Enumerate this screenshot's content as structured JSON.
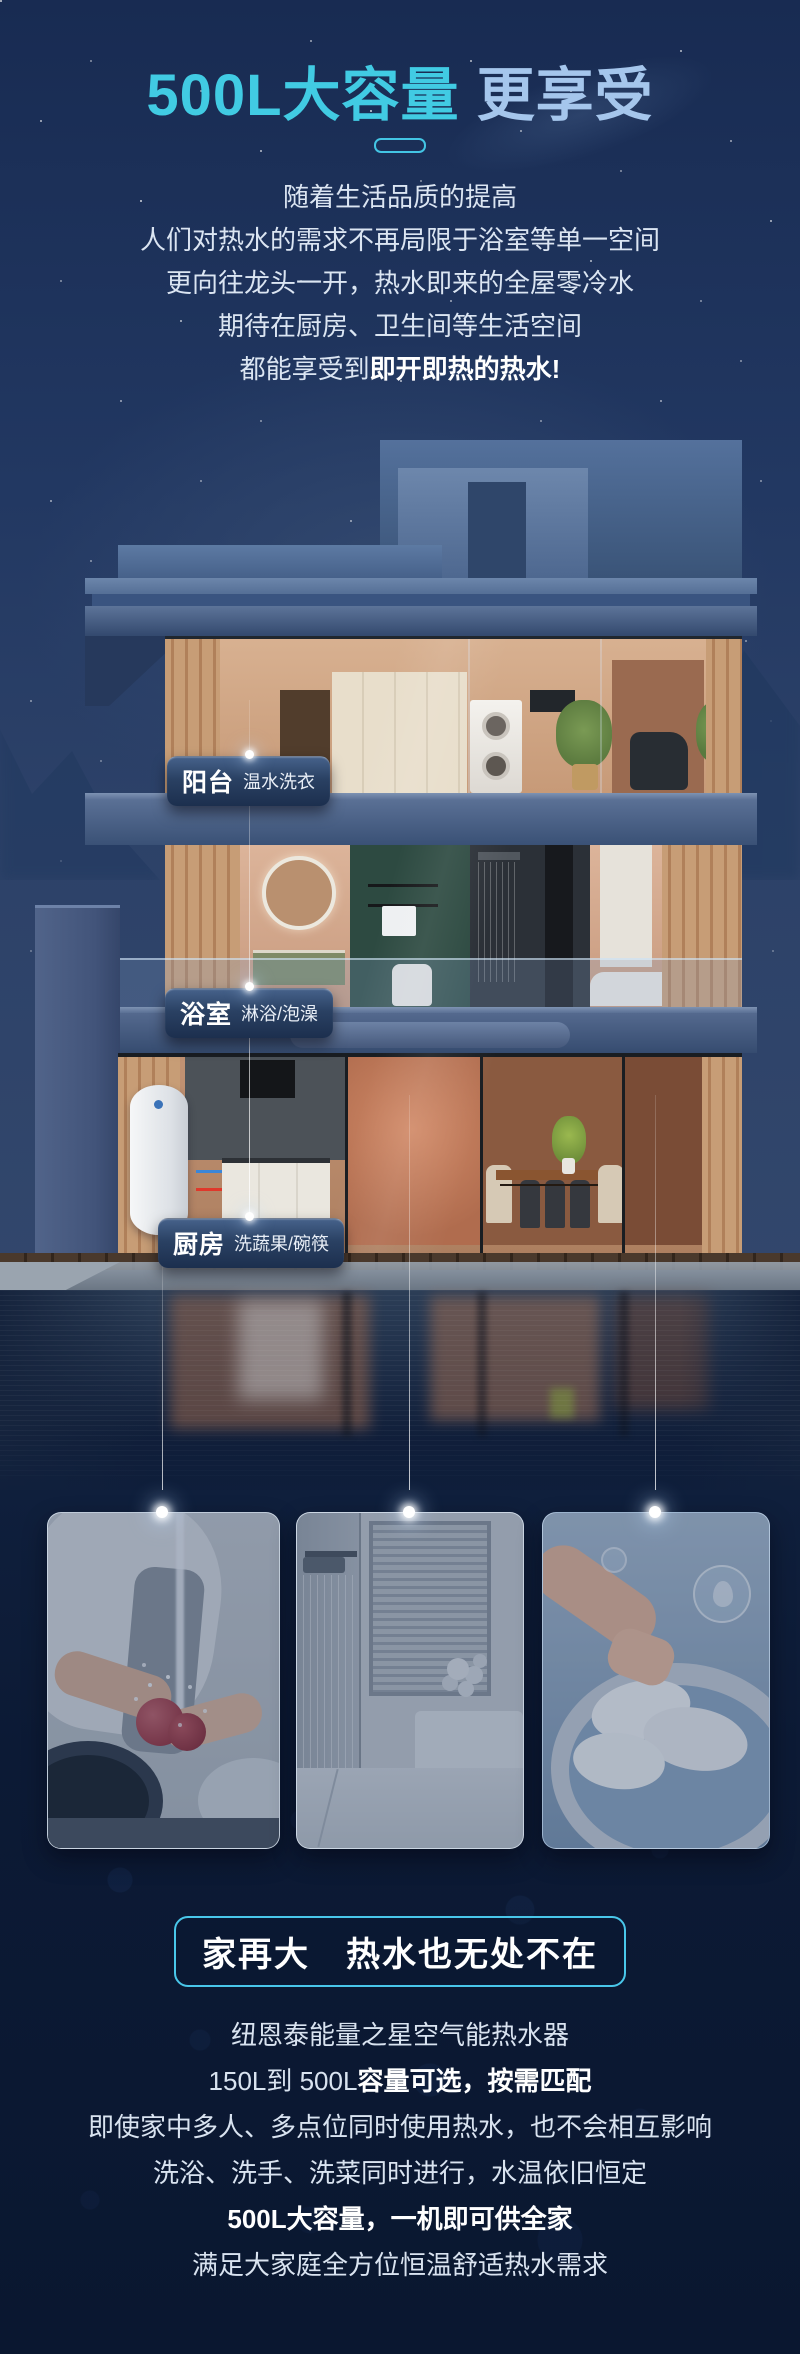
{
  "page": {
    "title_highlight": "500L大容量",
    "title_rest": " 更享受"
  },
  "intro": {
    "lines": [
      {
        "pre": "随着生活品质的提高"
      },
      {
        "pre": "人们对热水的需求不再局限于浴室等单一空间"
      },
      {
        "pre": "更向往龙头一开，热水即来的全屋零冷水"
      },
      {
        "pre": "期待在厨房、卫生间等生活空间"
      },
      {
        "pre": "都能享受到",
        "bold": "即开即热的热水!"
      }
    ]
  },
  "house": {
    "labels": [
      {
        "title": "阳台",
        "subtitle": "温水洗衣"
      },
      {
        "title": "浴室",
        "subtitle": "淋浴/泡澡"
      },
      {
        "title": "厨房",
        "subtitle": "洗蔬果/碗筷"
      }
    ],
    "pipes": {
      "cold_color": "#3b86d8",
      "hot_color": "#df382b"
    }
  },
  "gallery": {
    "cards": [
      {
        "photo": "washing-vegetables"
      },
      {
        "photo": "shower"
      },
      {
        "photo": "hand-washing-laundry"
      }
    ]
  },
  "outro": {
    "box_title": "家再大　热水也无处不在",
    "lines": [
      {
        "pre": "纽恩泰能量之星空气能热水器"
      },
      {
        "pre": "150L到 500L",
        "bold": "容量可选，按需匹配"
      },
      {
        "pre": "即使家中多人、多点位同时使用热水，也不会相互影响"
      },
      {
        "pre": "洗浴、洗手、洗菜同时进行，水温依旧恒定"
      },
      {
        "bold": "500L大容量，一机即可供全家"
      },
      {
        "pre": "满足大家庭全方位恒温舒适热水需求"
      }
    ]
  },
  "colors": {
    "accent_cyan": "#41cbe3",
    "title_secondary": "#a5c6ec",
    "sky": "#223862",
    "bottom_bg": "#0c1a35",
    "label_bg": "#2a4163"
  }
}
